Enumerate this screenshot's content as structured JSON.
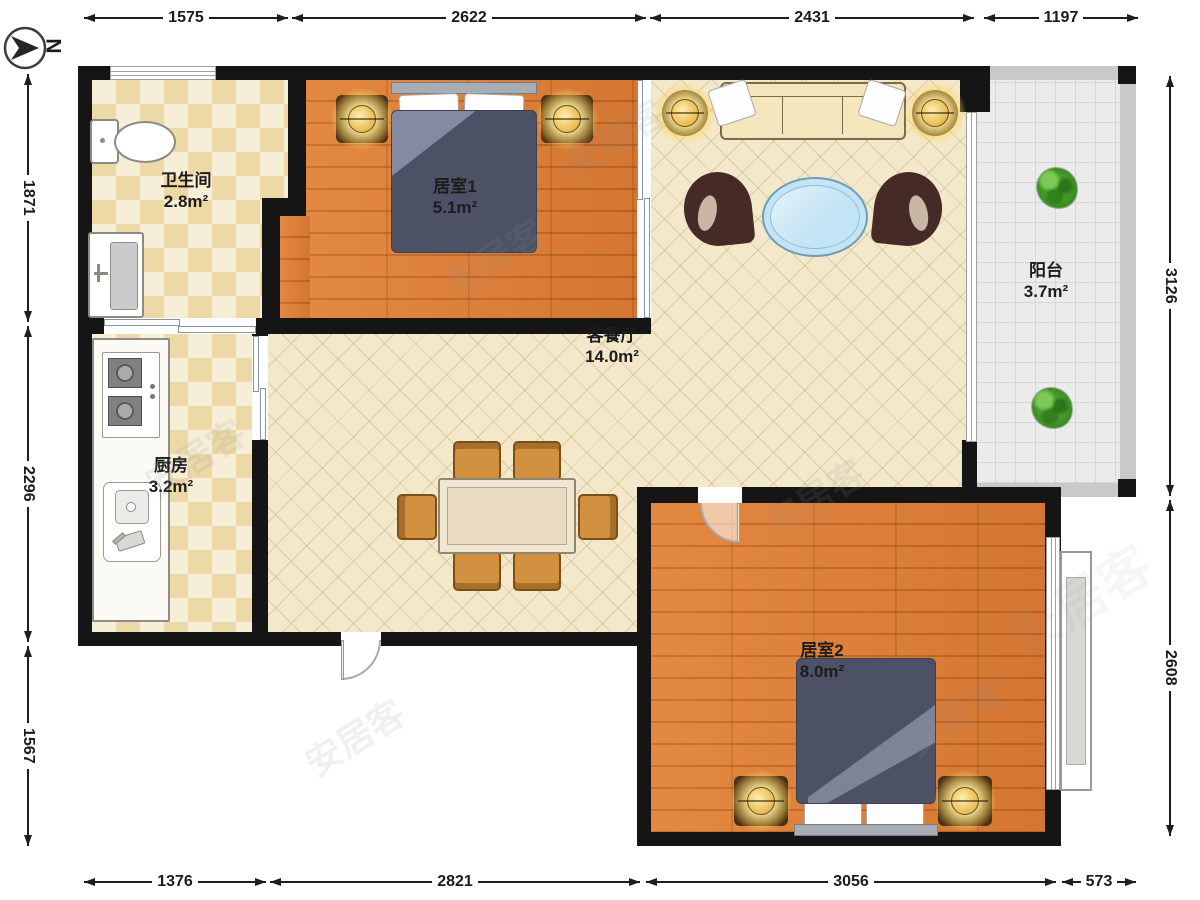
{
  "north_label": "N",
  "rooms": {
    "bathroom": {
      "name": "卫生间",
      "area": "2.8m²"
    },
    "bedroom1": {
      "name": "居室1",
      "area": "5.1m²"
    },
    "living": {
      "name": "客餐厅",
      "area": "14.0m²"
    },
    "kitchen": {
      "name": "厨房",
      "area": "3.2m²"
    },
    "balcony": {
      "name": "阳台",
      "area": "3.7m²"
    },
    "bedroom2": {
      "name": "居室2",
      "area": "8.0m²"
    }
  },
  "dimensions_mm": {
    "top": [
      "1575",
      "2622",
      "2431",
      "1197"
    ],
    "bottom": [
      "1376",
      "2821",
      "3056",
      "573"
    ],
    "left": [
      "1871",
      "2296",
      "1567"
    ],
    "right": [
      "3126",
      "2608"
    ]
  },
  "watermark_text": "安居客",
  "palette": {
    "wall": "#151515",
    "wood_floor": "#dd7f3a",
    "tile_accent": "#ecd9a6",
    "living_floor": "#f3e8c9",
    "balcony_floor": "#ebebeb",
    "duvet": "#4c5166",
    "sofa": "#f4e6bc",
    "coffee_table": "#c3e4f4",
    "dining_chair": "#d19140",
    "plant": "#3f9427",
    "dimension_text": "#1b1b1b"
  }
}
